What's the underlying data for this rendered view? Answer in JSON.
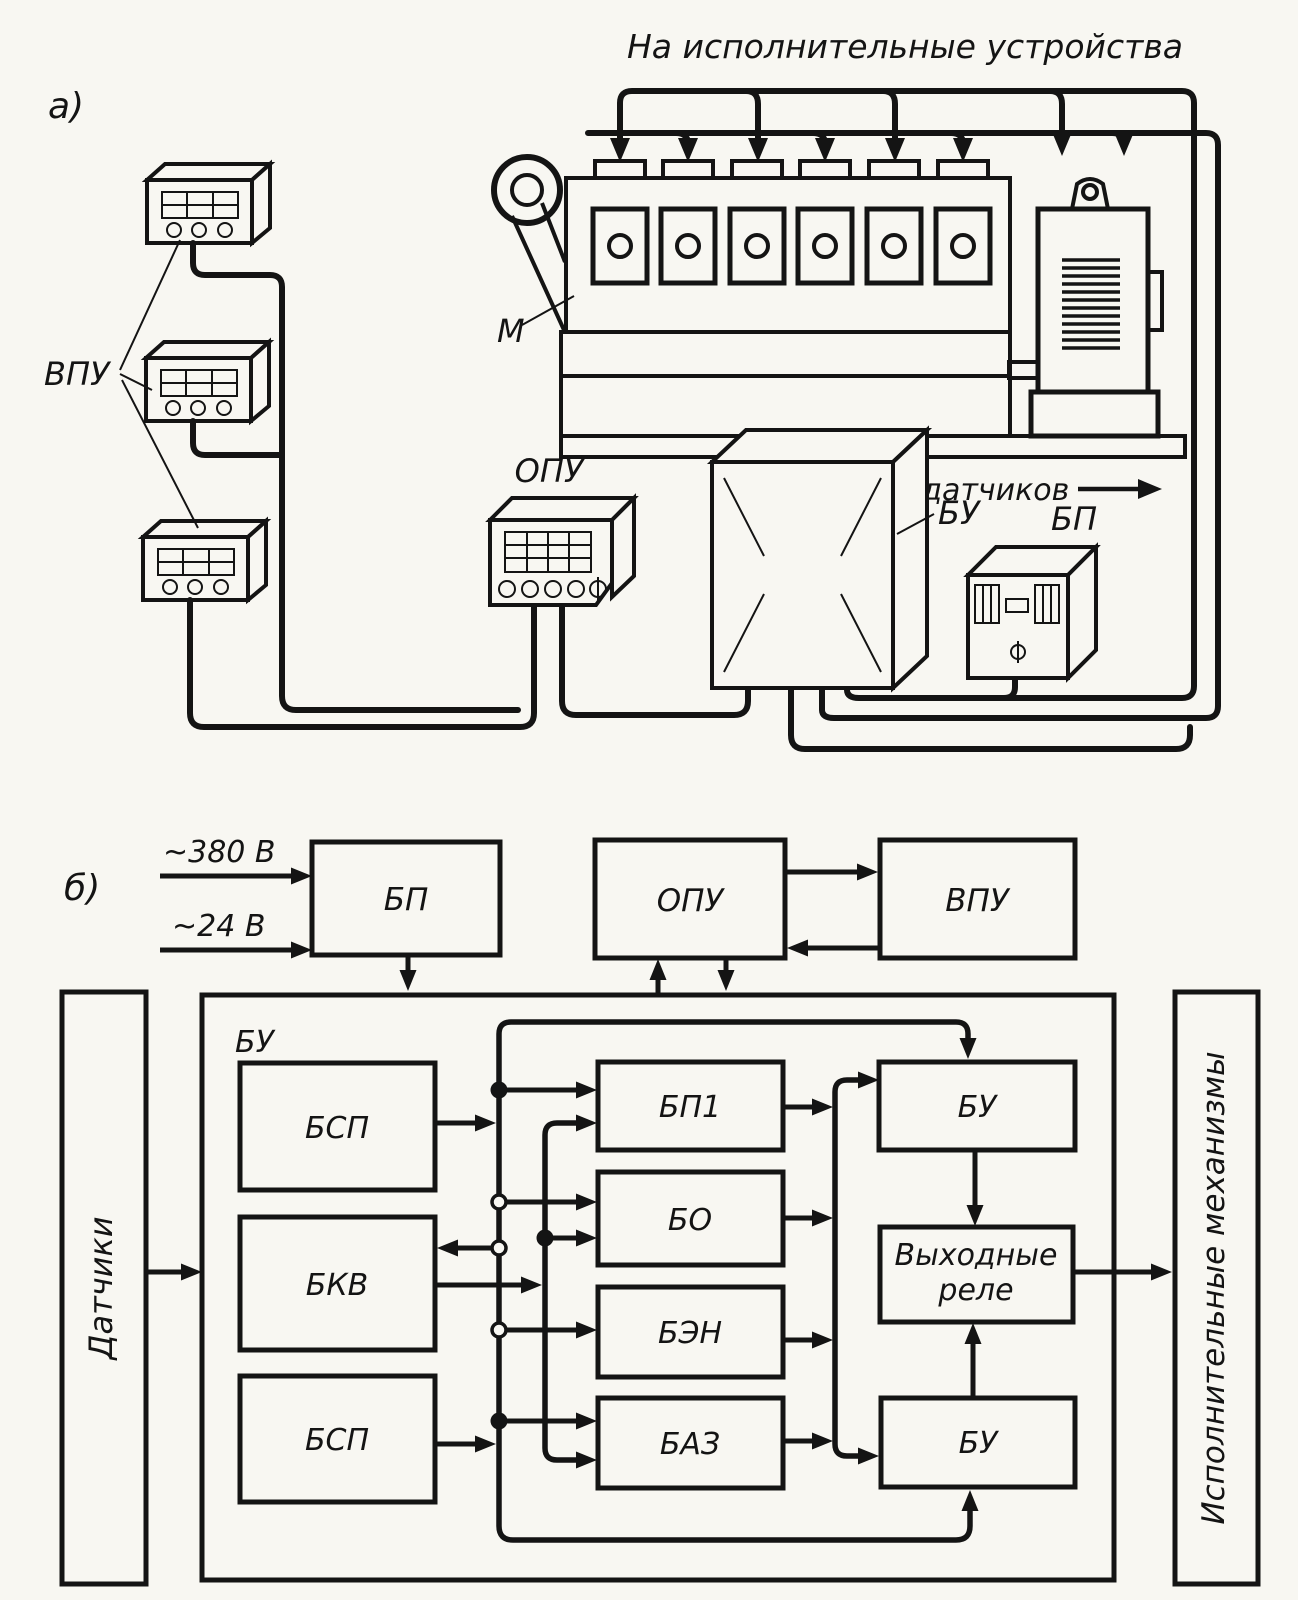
{
  "figure": {
    "part_a": {
      "label": "а)",
      "title": "На исполнительные устройства",
      "from_sensors": "От датчиков",
      "machine_label": "М",
      "vpu_label": "ВПУ",
      "opu_label": "ОПУ",
      "bu_label": "БУ",
      "bp_label": "БП"
    },
    "part_b": {
      "label": "б)",
      "input_380": "~380 В",
      "input_24": "~24 В",
      "bp": "БП",
      "opu": "ОПУ",
      "vpu": "ВПУ",
      "container": "БУ",
      "bsp1": "БСП",
      "bkv": "БКВ",
      "bsp2": "БСП",
      "bp1": "БП1",
      "bo": "БО",
      "ben": "БЭН",
      "baz": "БАЗ",
      "bu_top": "БУ",
      "relay_line1": "Выходные",
      "relay_line2": "реле",
      "bu_bottom": "БУ",
      "sensors": "Датчики",
      "actuators": "Исполнительные механизмы"
    }
  }
}
